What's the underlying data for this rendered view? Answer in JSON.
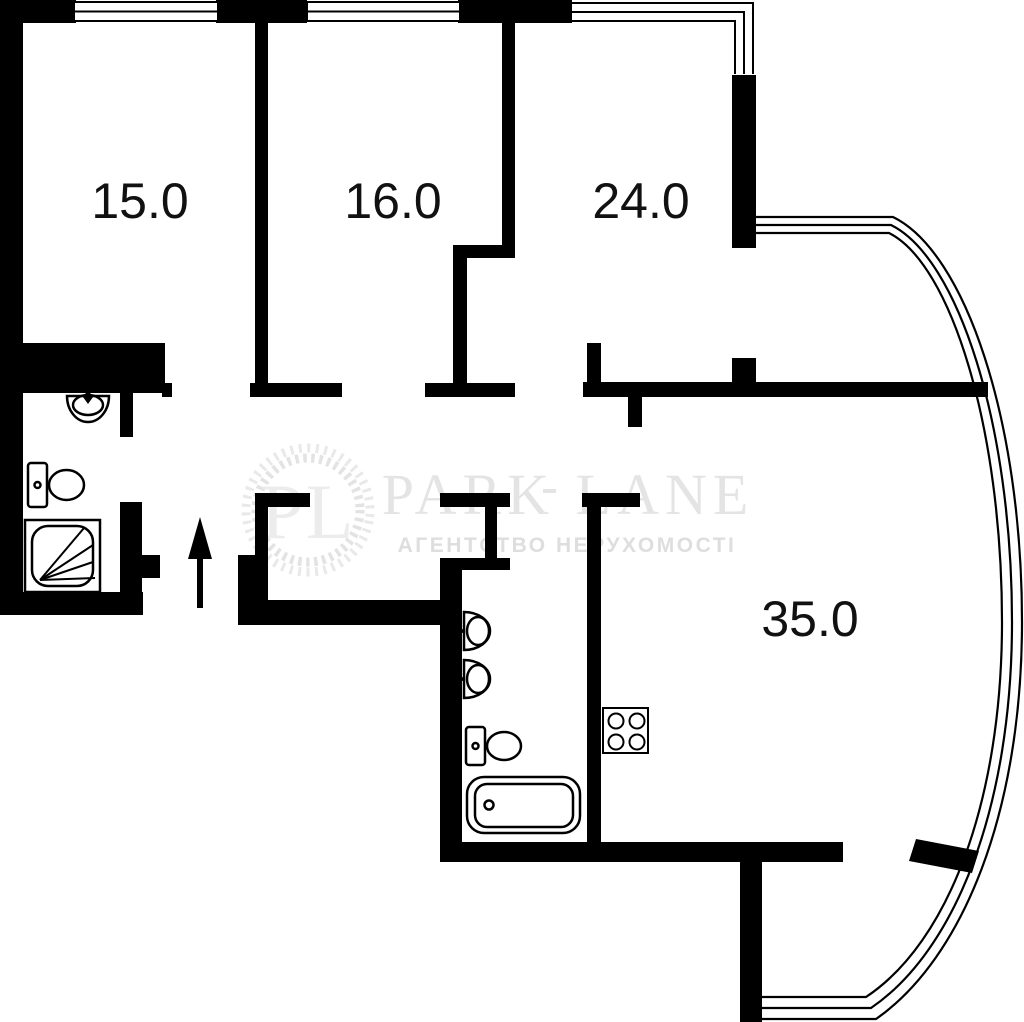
{
  "plan": {
    "type": "apartment-floor-plan",
    "rooms": [
      {
        "id": "room-top-left",
        "area_label": "15.0"
      },
      {
        "id": "room-top-middle",
        "area_label": "16.0"
      },
      {
        "id": "room-top-right",
        "area_label": "24.0"
      },
      {
        "id": "living-kitchen",
        "area_label": "35.0"
      }
    ],
    "fixtures": [
      "sink-icon",
      "toilet-icon",
      "shower-icon",
      "sink-icon",
      "sink-icon",
      "toilet-icon",
      "bathtub-icon",
      "stove-icon",
      "entrance-arrow-icon"
    ],
    "features": [
      "double-glazed-windows",
      "curved-bay-glazing",
      "balcony"
    ],
    "colors": {
      "walls": "#000000",
      "background": "#ffffff",
      "watermark_text": "#e4e4e4",
      "watermark_tagline": "#dedede",
      "label_text": "#111111"
    }
  },
  "watermark": {
    "monogram": "PL",
    "brand": "PARK LANE",
    "tagline": "АГЕНТСТВО НЕРУХОМОСТІ"
  }
}
